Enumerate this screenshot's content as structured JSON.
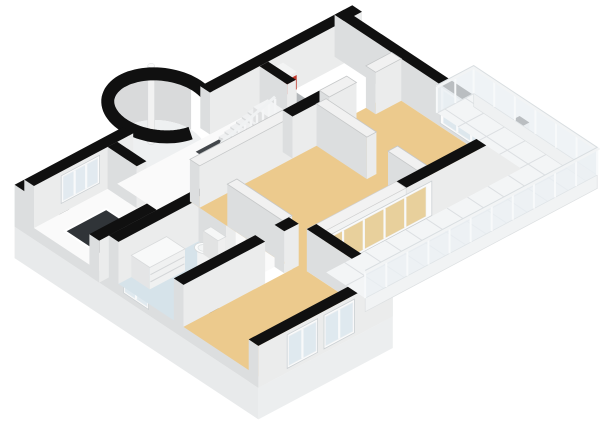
{
  "meta": {
    "view": "floorplan-3d",
    "background": "#ffffff"
  },
  "scene": {
    "proj": {
      "o": [
        34,
        228
      ],
      "u": [
        32,
        -17
      ],
      "v": [
        32.5,
        21.5
      ],
      "hs": 42
    },
    "colors": {
      "topB": "#101010",
      "topW": "#f1f1f1",
      "topWs": "#c6c8c9",
      "faceS": "#ebecec",
      "faceW": "#dcdedf",
      "tan": "#ecca8d",
      "bath": "#d6e3ea",
      "hall": "#fafafa",
      "closet": "#b3b7ba",
      "tile": "#f3f5f6",
      "tileLine": "#dcdfe2",
      "glassCool": "#dfe9ef",
      "glassEntry": "#e2eaf0",
      "glassTan": "#e8d09c",
      "railGlass": "rgba(234,239,243,0.78)",
      "dark": "#43474b",
      "darker": "#303438",
      "red": "#c23a2d",
      "redSide": "#ad3124",
      "white": "#fbfbfb"
    },
    "elements": [
      {
        "k": "band",
        "n": "turret-inner-wall",
        "i": false,
        "c": [
          4.3,
          -0.35
        ],
        "r": 1.0,
        "a0": 178,
        "a1": 362,
        "h": 1,
        "f": "#d9dadb"
      },
      {
        "k": "efloor",
        "n": "turret-floor",
        "i": true,
        "c": [
          4.3,
          -0.35
        ],
        "r": 1.0,
        "f": "#eef0f1"
      },
      {
        "k": "pole",
        "n": "chimney-pole",
        "i": false,
        "c": [
          4.22,
          -0.55
        ],
        "r": 0.105,
        "h": 1.9
      },
      {
        "k": "ring",
        "n": "turret-wall",
        "i": true,
        "c": [
          4.3,
          -0.35
        ],
        "r": 1.15,
        "a0": 100,
        "a1": 412,
        "w": 13,
        "f": "#101010"
      },
      {
        "k": "face",
        "n": "plinth-southwest",
        "i": false,
        "a": [
          -0.3,
          -0.3
        ],
        "b": [
          -0.3,
          7.2
        ],
        "t": 0,
        "b0": -0.75,
        "f": "#e8eaeb"
      },
      {
        "k": "wall",
        "n": "wall-southwest",
        "i": true,
        "u1": -0.3,
        "v1": -0.3,
        "u2": 0,
        "v2": 7.2,
        "h": 1,
        "top": "b"
      },
      {
        "k": "win",
        "n": "window-bathroom",
        "i": true,
        "a": [
          -0.3,
          3.05
        ],
        "b": [
          -0.3,
          3.82
        ],
        "t": 0.82,
        "b0": 0.14,
        "f": "#dfe9ef",
        "m": 1
      },
      {
        "k": "wall",
        "n": "wall-northwest-west",
        "i": true,
        "u1": 0,
        "v1": -0.3,
        "u2": 3.1,
        "v2": 0,
        "h": 1,
        "top": "b"
      },
      {
        "k": "win",
        "n": "window-entry",
        "i": true,
        "a": [
          0.85,
          0
        ],
        "b": [
          2.05,
          0
        ],
        "t": 0.9,
        "b0": 0.24,
        "f": "#e2eaf0",
        "m": 2
      },
      {
        "k": "wall",
        "n": "wall-northwest-east",
        "i": true,
        "u1": 5.5,
        "v1": -0.3,
        "u2": 10.25,
        "v2": 0,
        "h": 1,
        "top": "b"
      },
      {
        "k": "floor",
        "n": "closet-floor",
        "i": true,
        "pts": [
          [
            7.05,
            0
          ],
          [
            8.1,
            0
          ],
          [
            8.1,
            1.45
          ],
          [
            7.05,
            1.45
          ]
        ],
        "f": "#b3b7ba"
      },
      {
        "k": "box",
        "n": "boiler",
        "i": true,
        "u1": 7.18,
        "v1": 0.1,
        "u2": 7.68,
        "v2": 0.52,
        "h": 0.88,
        "ct": "#f3f4f4",
        "cs": "#ececec",
        "cw": "#e0e1e2"
      },
      {
        "k": "face",
        "n": "boiler-red-front",
        "i": false,
        "a": [
          7.18,
          0.52
        ],
        "b": [
          7.68,
          0.52
        ],
        "t": 0.8,
        "b0": 0.46,
        "f": "#c23a2d"
      },
      {
        "k": "face",
        "n": "boiler-red-side",
        "i": false,
        "a": [
          7.18,
          0.1
        ],
        "b": [
          7.18,
          0.52
        ],
        "t": 0.8,
        "b0": 0.46,
        "f": "#ad3124"
      },
      {
        "k": "wall",
        "n": "closet-stub-wall",
        "i": true,
        "u1": 7.05,
        "v1": 0,
        "u2": 7.32,
        "v2": 0.85,
        "h": 1,
        "top": "b"
      },
      {
        "k": "wall",
        "n": "wall-northeast",
        "i": true,
        "u1": 9.7,
        "v1": -0.3,
        "u2": 10,
        "v2": 5,
        "h": 1,
        "top": "b"
      },
      {
        "k": "win",
        "n": "window-bedroom-ne",
        "i": true,
        "a": [
          9.7,
          2.95
        ],
        "b": [
          9.7,
          4.85
        ],
        "t": 0.96,
        "b0": 0.08,
        "f": "#dde7ed",
        "m": 3
      },
      {
        "k": "floor",
        "n": "entry-floor",
        "i": true,
        "pts": [
          [
            0,
            0
          ],
          [
            2.3,
            0
          ],
          [
            2.3,
            2.0
          ],
          [
            0,
            2.0
          ]
        ],
        "f": "#fafafa"
      },
      {
        "k": "floor",
        "n": "entry-stair-void",
        "i": false,
        "pts": [
          [
            0.45,
            0.5
          ],
          [
            1.75,
            0.5
          ],
          [
            1.75,
            1.93
          ],
          [
            0.45,
            1.93
          ]
        ],
        "f": "#303438",
        "s": "#ffffff",
        "sw": 2
      },
      {
        "k": "wall",
        "n": "wall-entry-south",
        "i": true,
        "u1": -0.3,
        "v1": 2.0,
        "u2": 2.6,
        "v2": 2.3,
        "h": 1,
        "top": "b"
      },
      {
        "k": "wall",
        "n": "wall-entry-east-north",
        "i": true,
        "u1": 2.3,
        "v1": 0,
        "u2": 2.6,
        "v2": 0.9,
        "h": 1,
        "top": "b"
      },
      {
        "k": "wall",
        "n": "wall-entry-east-south",
        "i": true,
        "u1": 2.3,
        "v1": 1.5,
        "u2": 2.6,
        "v2": 2.0,
        "h": 1,
        "top": "b"
      },
      {
        "k": "floor",
        "n": "hallway-floor",
        "i": true,
        "pts": [
          [
            2.6,
            0
          ],
          [
            7.05,
            0
          ],
          [
            7.05,
            1.45
          ],
          [
            3.4,
            1.45
          ],
          [
            3.4,
            4.3
          ],
          [
            2.6,
            4.3
          ]
        ],
        "f": "#fafafa"
      },
      {
        "k": "floor",
        "n": "stairwell-void",
        "i": false,
        "pts": [
          [
            4.8,
            0.25
          ],
          [
            6.6,
            0.25
          ],
          [
            6.6,
            0.95
          ],
          [
            4.8,
            0.95
          ]
        ],
        "f": "#43474b"
      },
      {
        "k": "box",
        "n": "stair-tread",
        "i": false,
        "u1": 6.42,
        "v1": 0.25,
        "u2": 6.6,
        "v2": 0.95,
        "h": 0.3,
        "ct": "#eff0f1",
        "cs": "#e6e8e9",
        "cw": "#d9dbdc"
      },
      {
        "k": "box",
        "n": "stair-tread",
        "i": false,
        "u1": 6.24,
        "v1": 0.25,
        "u2": 6.42,
        "v2": 0.95,
        "h": 0.255,
        "ct": "#eff0f1",
        "cs": "#e6e8e9",
        "cw": "#d9dbdc"
      },
      {
        "k": "box",
        "n": "stair-tread",
        "i": false,
        "u1": 6.06,
        "v1": 0.25,
        "u2": 6.24,
        "v2": 0.95,
        "h": 0.21,
        "ct": "#eff0f1",
        "cs": "#e6e8e9",
        "cw": "#d9dbdc"
      },
      {
        "k": "box",
        "n": "stair-tread",
        "i": false,
        "u1": 5.88,
        "v1": 0.25,
        "u2": 6.06,
        "v2": 0.95,
        "h": 0.165,
        "ct": "#eff0f1",
        "cs": "#e6e8e9",
        "cw": "#d9dbdc"
      },
      {
        "k": "box",
        "n": "stair-tread",
        "i": false,
        "u1": 5.7,
        "v1": 0.25,
        "u2": 5.88,
        "v2": 0.95,
        "h": 0.12,
        "ct": "#eff0f1",
        "cs": "#e6e8e9",
        "cw": "#d9dbdc"
      },
      {
        "k": "box",
        "n": "stair-tread",
        "i": false,
        "u1": 5.52,
        "v1": 0.25,
        "u2": 5.7,
        "v2": 0.95,
        "h": 0.075,
        "ct": "#eff0f1",
        "cs": "#e6e8e9",
        "cw": "#d9dbdc"
      },
      {
        "k": "box",
        "n": "stair-landing",
        "i": false,
        "u1": 6.6,
        "v1": 0.25,
        "u2": 7.05,
        "v2": 0.95,
        "h": 0.34,
        "ct": "#f2f3f4",
        "cs": "#eaebec",
        "cw": "#dfe0e1"
      },
      {
        "k": "slats",
        "n": "stair-railing",
        "i": false,
        "a": [
          4.85,
          0.97
        ],
        "b": [
          6.55,
          0.97
        ],
        "n2": 10,
        "h0": 0.5,
        "h1": 0.92
      },
      {
        "k": "floor",
        "n": "bathroom-floor",
        "i": true,
        "pts": [
          [
            0,
            2.3
          ],
          [
            2.5,
            2.3
          ],
          [
            2.5,
            4.3
          ],
          [
            0,
            4.3
          ]
        ],
        "f": "#d6e3ea"
      },
      {
        "k": "wall",
        "n": "wall-bathroom-north",
        "i": true,
        "u1": 0,
        "v1": 2.3,
        "u2": 2.8,
        "v2": 2.6,
        "h": 1,
        "top": "b"
      },
      {
        "k": "wall",
        "n": "wall-bathroom-east-north",
        "i": true,
        "u1": 2.5,
        "v1": 2.6,
        "u2": 2.8,
        "v2": 3.45,
        "h": 1,
        "top": "b"
      },
      {
        "k": "wall",
        "n": "wall-bathroom-east-south",
        "i": true,
        "u1": 2.5,
        "v1": 4.05,
        "u2": 2.8,
        "v2": 4.3,
        "h": 1,
        "top": "b"
      },
      {
        "k": "box",
        "n": "vanity",
        "i": true,
        "u1": 0.4,
        "v1": 2.6,
        "u2": 1.5,
        "v2": 3.17,
        "h": 0.52,
        "ct": "#f8f9f9",
        "cs": "#f0f1f1",
        "cw": "#e4e5e6",
        "s": "#d8dadb"
      },
      {
        "k": "fline",
        "n": "vanity-drawer-line",
        "i": false,
        "a": [
          0.42,
          3.17
        ],
        "b": [
          1.48,
          3.17
        ],
        "h": 0.34,
        "s": "#d4d6d8",
        "sw": 1
      },
      {
        "k": "fline",
        "n": "vanity-drawer-line",
        "i": false,
        "a": [
          0.42,
          3.17
        ],
        "b": [
          1.48,
          3.17
        ],
        "h": 0.17,
        "s": "#d4d6d8",
        "sw": 1
      },
      {
        "k": "bowl",
        "n": "toilet-bowl",
        "i": true,
        "c": [
          2.02,
          3.23
        ],
        "r": 0.2,
        "h": 0.36
      },
      {
        "k": "box",
        "n": "toilet-tank",
        "i": true,
        "u1": 2.24,
        "v1": 3.0,
        "u2": 2.48,
        "v2": 3.46,
        "h": 0.56,
        "ct": "#f6f7f7",
        "cs": "#efefef",
        "cw": "#e2e3e3",
        "s": "#d8dadb"
      },
      {
        "k": "floor",
        "n": "living-room-floor",
        "i": true,
        "pts": [
          [
            3.4,
            1.45
          ],
          [
            9.7,
            1.45
          ],
          [
            9.7,
            4.85
          ],
          [
            3.4,
            4.85
          ]
        ],
        "f": "#ecca8d"
      },
      {
        "k": "wall",
        "n": "wall-corridor-south",
        "i": true,
        "u1": 3.4,
        "v1": 1.45,
        "u2": 6.3,
        "v2": 1.75,
        "h": 1,
        "top": "w"
      },
      {
        "k": "wall",
        "n": "wall-corridor-south-black",
        "i": true,
        "u1": 6.3,
        "v1": 1.45,
        "u2": 7.45,
        "v2": 1.75,
        "h": 1,
        "top": "b"
      },
      {
        "k": "wall",
        "n": "wall-bedroom-nw-west",
        "i": true,
        "u1": 7.45,
        "v1": 1.45,
        "u2": 8.3,
        "v2": 1.75,
        "h": 1,
        "top": "w"
      },
      {
        "k": "wall",
        "n": "wall-bedroom-nw-east",
        "i": true,
        "u1": 8.9,
        "v1": 1.45,
        "u2": 9.7,
        "v2": 1.75,
        "h": 1,
        "top": "w"
      },
      {
        "k": "wall",
        "n": "wall-hall-living",
        "i": true,
        "u1": 3.4,
        "v1": 2.6,
        "u2": 3.7,
        "v2": 4.3,
        "h": 1,
        "top": "w"
      },
      {
        "k": "wall",
        "n": "wall-living-bedroom-north",
        "i": true,
        "u1": 7.05,
        "v1": 1.75,
        "u2": 7.35,
        "v2": 3.3,
        "h": 1,
        "top": "w"
      },
      {
        "k": "wall",
        "n": "wall-living-bedroom-south",
        "i": true,
        "u1": 7.05,
        "v1": 3.95,
        "u2": 7.35,
        "v2": 4.85,
        "h": 1,
        "top": "w"
      },
      {
        "k": "wall",
        "n": "wall-wing-north-west",
        "i": true,
        "u1": 0,
        "v1": 4.3,
        "u2": 2.55,
        "v2": 4.6,
        "h": 1,
        "top": "b"
      },
      {
        "k": "wall",
        "n": "wall-wing-north-east",
        "i": true,
        "u1": 3.15,
        "v1": 4.3,
        "u2": 3.6,
        "v2": 4.6,
        "h": 1,
        "top": "b"
      },
      {
        "k": "floor",
        "n": "bedroom-bottom-floor",
        "i": true,
        "pts": [
          [
            0,
            4.6
          ],
          [
            3.6,
            4.6
          ],
          [
            3.6,
            6.9
          ],
          [
            0,
            6.9
          ]
        ],
        "f": "#ecca8d"
      },
      {
        "k": "wall",
        "n": "wall-bedroom-se",
        "i": true,
        "u1": 6.4,
        "v1": 4.85,
        "u2": 10.25,
        "v2": 5.15,
        "h": 1,
        "top": "b"
      },
      {
        "k": "face",
        "n": "facade-header",
        "i": false,
        "a": [
          3.6,
          5.15
        ],
        "b": [
          6.4,
          5.15
        ],
        "t": 1,
        "b0": 0.84,
        "f": "#f2f3f3",
        "s": "#dadcdd",
        "sw": 0.7
      },
      {
        "k": "floor",
        "n": "facade-header-top",
        "i": false,
        "pts": [
          [
            3.6,
            4.85
          ],
          [
            6.4,
            4.85
          ],
          [
            6.4,
            5.15
          ],
          [
            3.6,
            5.15
          ]
        ],
        "f": "#f2f2f2",
        "s": "#cfcfcf",
        "sw": 0.7,
        "h": 1
      },
      {
        "k": "win",
        "n": "window-living-facade",
        "i": true,
        "a": [
          3.6,
          5.15
        ],
        "b": [
          7.2,
          5.15
        ],
        "t": 0.84,
        "b0": 0.02,
        "f": "#e8d09c",
        "m": 4
      },
      {
        "k": "wall",
        "n": "wall-wing-east",
        "i": true,
        "u1": 3.6,
        "v1": 4.85,
        "u2": 3.9,
        "v2": 7.2,
        "h": 1,
        "top": "b"
      },
      {
        "k": "face",
        "n": "plinth-wing-south",
        "i": false,
        "a": [
          -0.3,
          7.2
        ],
        "b": [
          3.9,
          7.2
        ],
        "t": 0,
        "b0": -0.75,
        "f": "#eceeef"
      },
      {
        "k": "wall",
        "n": "wall-wing-south",
        "i": true,
        "u1": -0.3,
        "v1": 6.9,
        "u2": 3.9,
        "v2": 7.2,
        "h": 1,
        "top": "b"
      },
      {
        "k": "win",
        "n": "window-wing-west",
        "i": true,
        "a": [
          0.6,
          7.2
        ],
        "b": [
          1.55,
          7.2
        ],
        "t": 0.9,
        "b0": 0.1,
        "f": "#dfe9ef",
        "m": 1
      },
      {
        "k": "win",
        "n": "window-wing-east",
        "i": true,
        "a": [
          1.75,
          7.2
        ],
        "b": [
          2.7,
          7.2
        ],
        "t": 0.9,
        "b0": 0.1,
        "f": "#dfe9ef",
        "m": 1
      },
      {
        "k": "floor",
        "n": "balcony-floor",
        "i": true,
        "pts": [
          [
            10,
            2.55
          ],
          [
            11.15,
            2.55
          ],
          [
            11.15,
            6.35
          ],
          [
            3.9,
            6.35
          ],
          [
            3.9,
            5.15
          ],
          [
            10,
            5.15
          ]
        ],
        "f": "#f3f5f6",
        "grid": {
          "p": 0.64,
          "c": "#dcdfe2",
          "w": 1
        }
      },
      {
        "k": "face",
        "n": "balcony-slab-east",
        "i": false,
        "a": [
          11.15,
          2.55
        ],
        "b": [
          11.15,
          6.35
        ],
        "t": 0,
        "b0": -0.32,
        "f": "#eff1f2",
        "s": "#dde0e2",
        "sw": 0.7
      },
      {
        "k": "face",
        "n": "balcony-slab-south",
        "i": false,
        "a": [
          3.9,
          6.35
        ],
        "b": [
          11.15,
          6.35
        ],
        "t": 0,
        "b0": -0.32,
        "f": "#f1f3f4",
        "s": "#dde0e2",
        "sw": 0.7
      },
      {
        "k": "rail",
        "n": "balcony-railing",
        "i": true,
        "pts": [
          [
            10,
            2.55
          ],
          [
            11.15,
            2.55
          ],
          [
            11.15,
            6.35
          ],
          [
            3.9,
            6.35
          ]
        ],
        "h": 0.62,
        "p": 0.64
      }
    ]
  }
}
